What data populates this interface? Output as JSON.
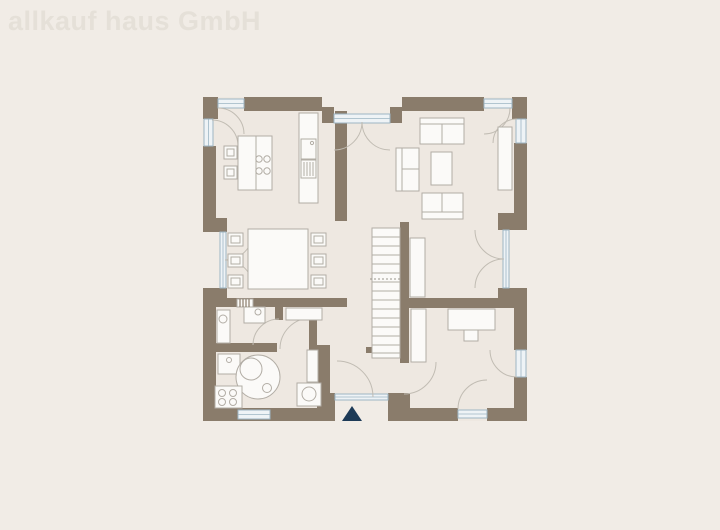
{
  "watermark": {
    "text": "allkauf haus GmbH"
  },
  "palette": {
    "background": "#f1ece6",
    "floor": "#eee8e1",
    "wall": "#8a7c6b",
    "furniture_stroke": "#b2ada5",
    "window_stroke": "#9db6c4",
    "window_fill": "#eef3f6",
    "door_arc": "#c1bcb3",
    "entrance_marker": "#1d3a57",
    "watermark_color": "#e5e0d8"
  },
  "floor_plan": {
    "type": "ground-floor-plan",
    "symbols": [
      "kitchen-counter",
      "kitchen-sink",
      "dishwasher",
      "kitchen-island-with-cooktop",
      "bar-stools",
      "dining-table-six-chairs",
      "terrace-french-doors-top",
      "sofa-top",
      "sofa-left",
      "coffee-table",
      "sofa-bottom",
      "sideboard",
      "french-doors-right",
      "french-doors-left-dining",
      "staircase",
      "hall-cabinet",
      "office-desk-with-chair",
      "office-wardrobe",
      "utility-washer",
      "utility-sink-unit",
      "utility-counter",
      "washbasin",
      "round-water-tank",
      "heat-pump-unit",
      "radiator",
      "washing-machine",
      "entrance-door",
      "entrance-direction-triangle",
      "windows-with-opening-arcs"
    ]
  }
}
